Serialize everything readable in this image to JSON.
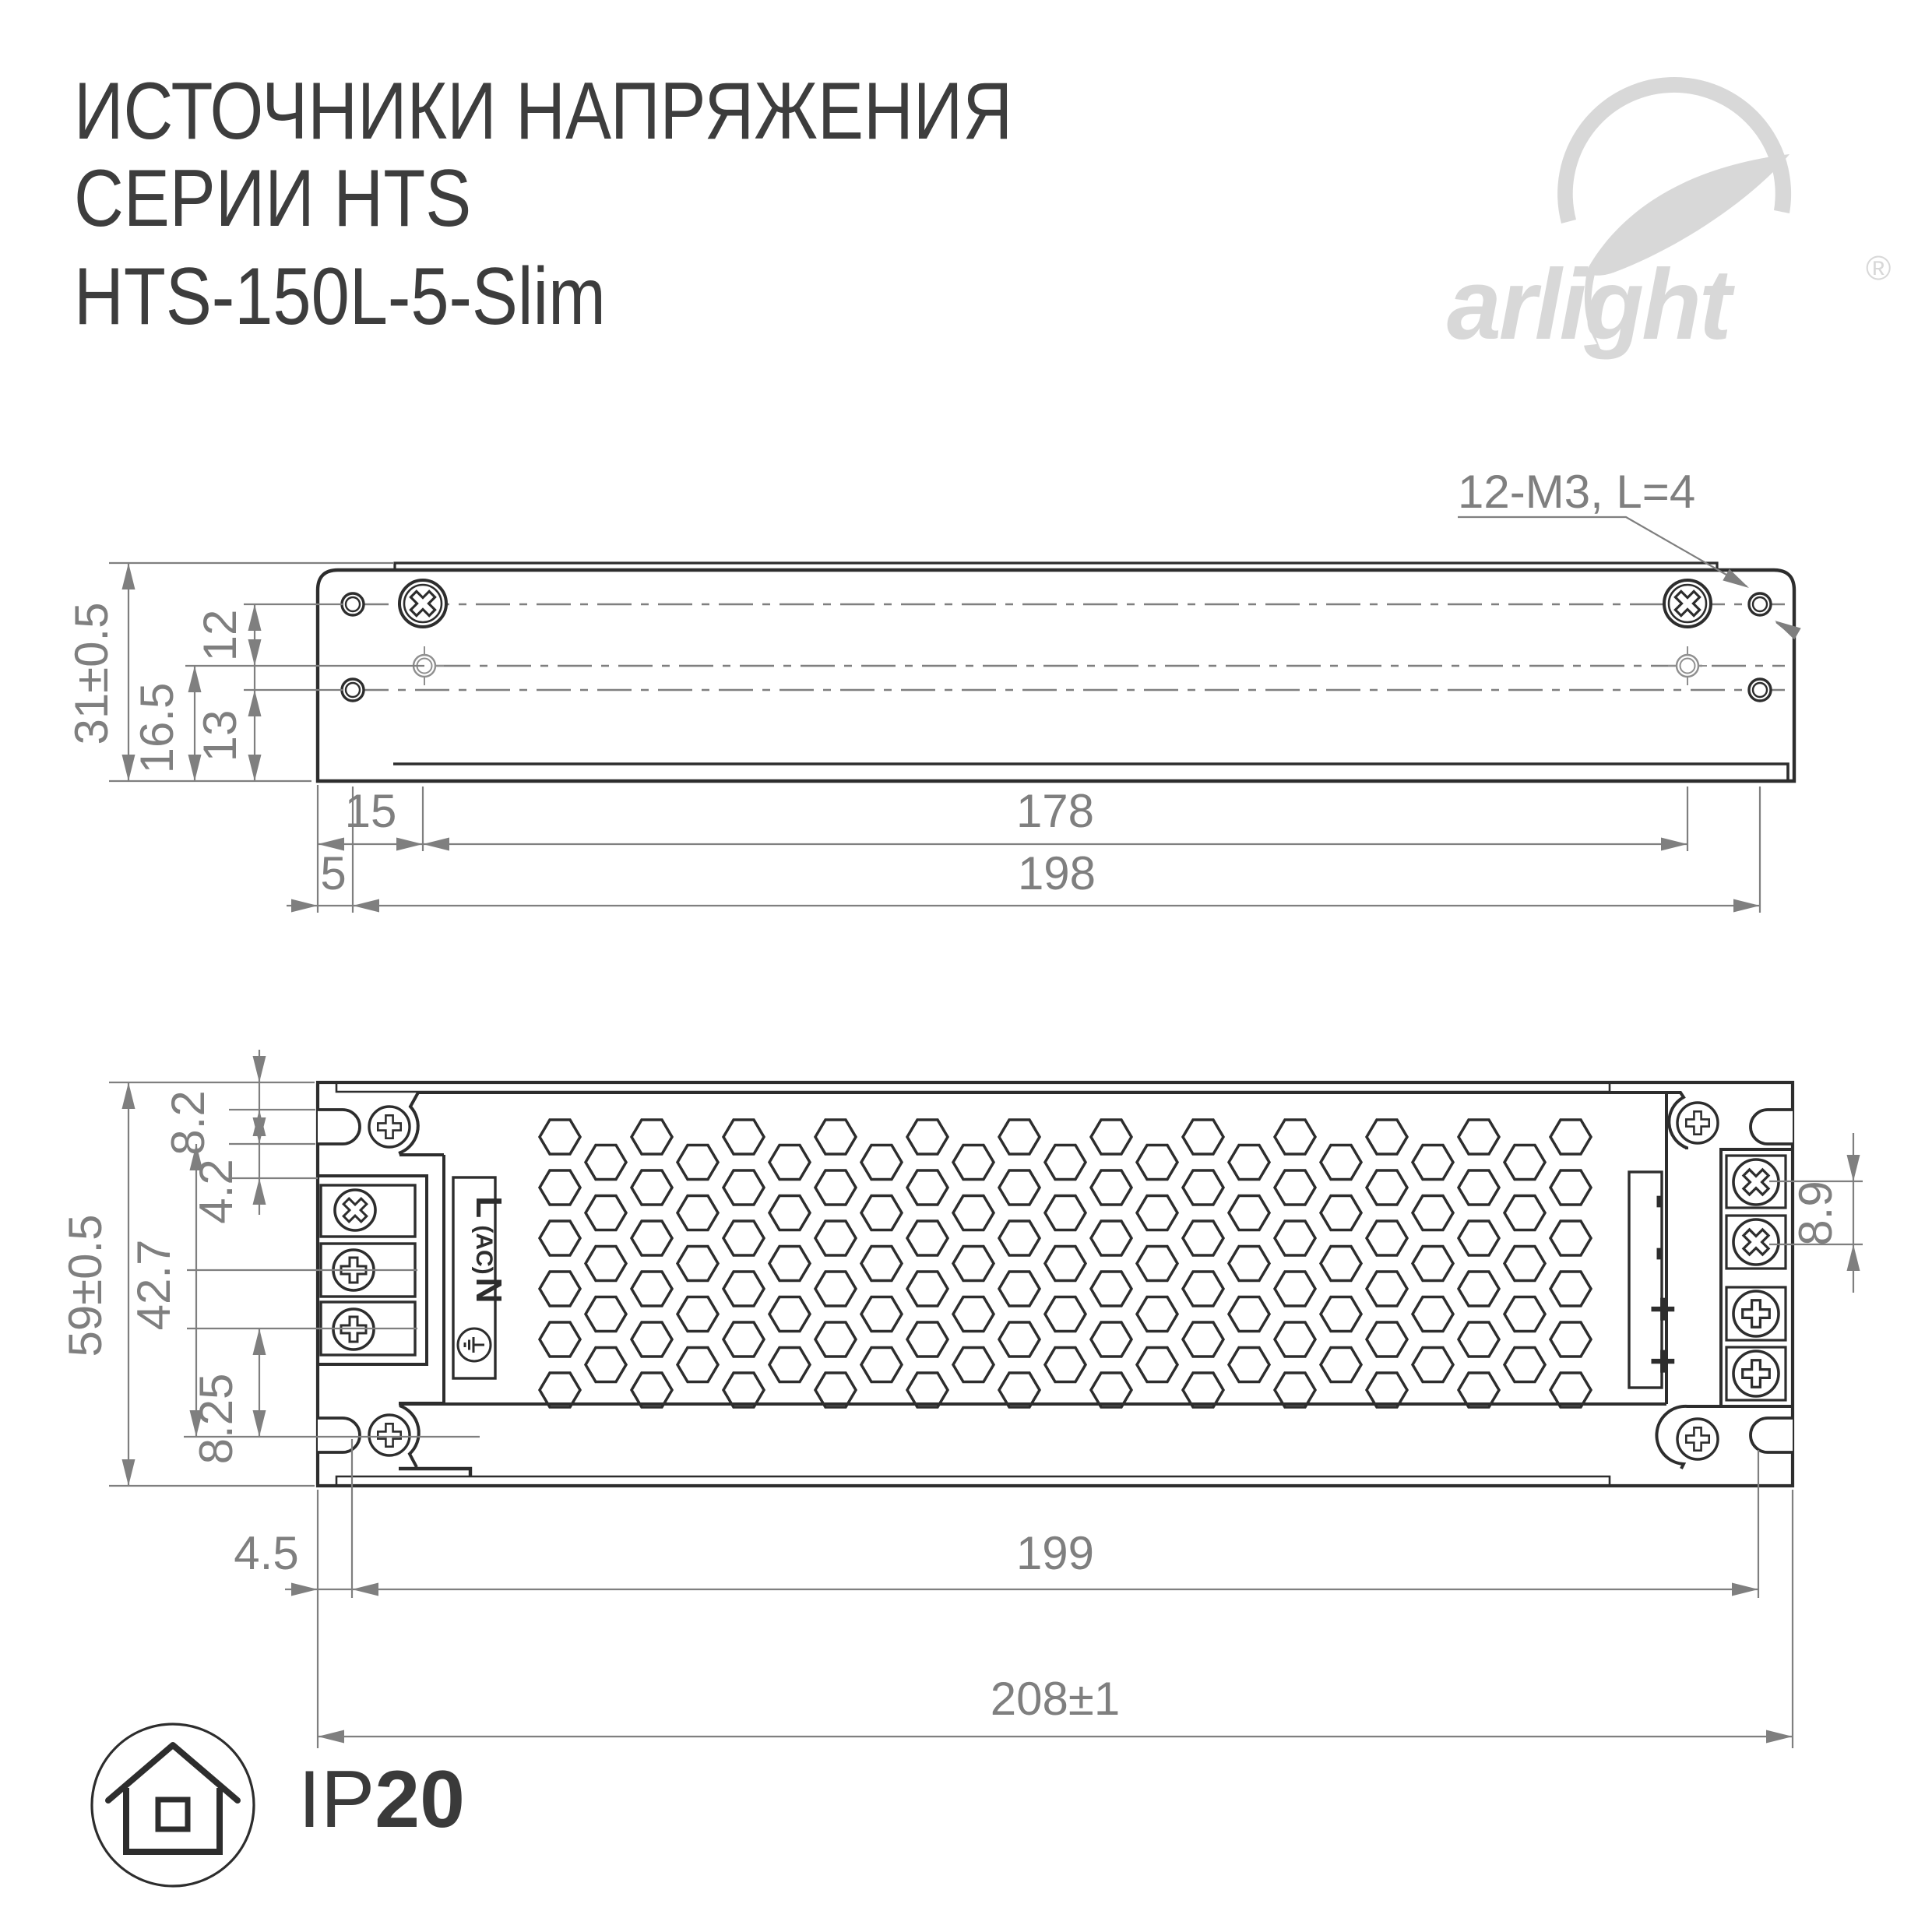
{
  "title": {
    "line1": "ИСТОЧНИКИ НАПРЯЖЕНИЯ",
    "line2": "СЕРИИ HTS",
    "model": "HTS-150L-5-Slim"
  },
  "brand": {
    "wordmark": "arlight",
    "registered": "®"
  },
  "side_view": {
    "thread_label": "12-M3, L=4",
    "dim_height": "31±0.5",
    "dim_hole_offset": "12",
    "dim_mid": "16.5",
    "dim_low": "13",
    "dim_15": "15",
    "dim_178": "178",
    "dim_5": "5",
    "dim_198": "198"
  },
  "top_view": {
    "dim_8_2": "8.2",
    "dim_4_2": "4.2",
    "dim_42_7": "42.7",
    "dim_8_25": "8.25",
    "dim_height": "59±0.5",
    "dim_8_9": "8.9",
    "dim_4_5": "4.5",
    "dim_199": "199",
    "dim_width": "208±1",
    "input_labels": {
      "line": "L",
      "ac": "(AC)",
      "neutral": "N"
    },
    "output_labels": {
      "m1": "-",
      "m2": "-",
      "p1": "+",
      "p2": "+"
    }
  },
  "footer": {
    "ip_prefix": "IP",
    "ip_value": "20"
  },
  "colors": {
    "line_dark": "#2d2d2d",
    "dim_gray": "#7f7f7f",
    "logo_gray": "#d8d8d8",
    "text_dark": "#3d3d3d"
  }
}
